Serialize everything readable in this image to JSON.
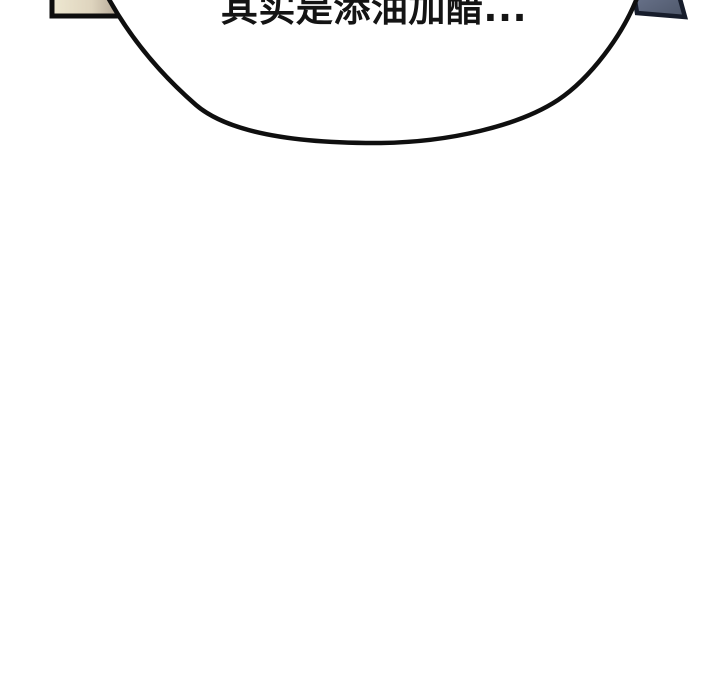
{
  "page": {
    "background": "#ffffff",
    "width": 720,
    "height": 700
  },
  "speech_bubble": {
    "text": "其实是添油加醋...",
    "fill": "#ffffff",
    "outline": "#0f0f0f",
    "text_color": "#141414"
  },
  "top_panels": {
    "left": {
      "fill_start": "#eee8d1",
      "fill_mid": "#ded4be",
      "fill_end": "#ab9d8d",
      "border": "#0e0e0e"
    },
    "right": {
      "fill_start": "#6d7790",
      "fill_end": "#4d5669",
      "border": "#161c2b"
    }
  }
}
